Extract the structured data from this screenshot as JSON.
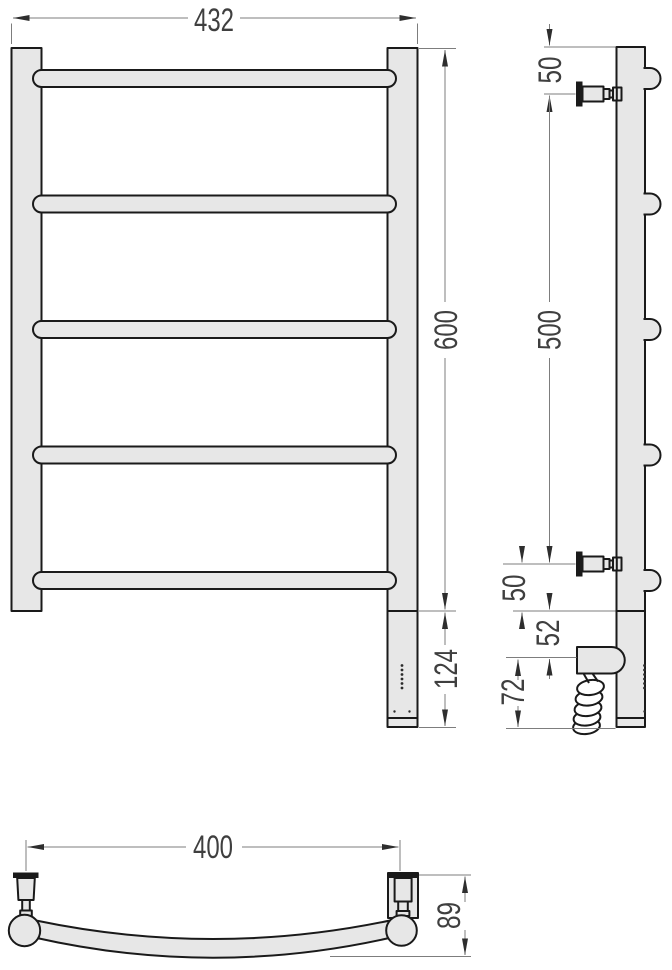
{
  "drawing": {
    "dims": {
      "front_width": "432",
      "front_height": "600",
      "front_bottom": "124",
      "side_top": "50",
      "side_span": "500",
      "side_bottom": "50",
      "side_elem_offset": "52",
      "side_elem": "72",
      "top_width": "400",
      "top_depth": "89"
    },
    "colors": {
      "part_fill": "#e7e7e7",
      "part_outline": "#1a1a1a",
      "dim_line": "#7d7d7d",
      "dim_text": "#3f3f3f",
      "background": "#ffffff"
    }
  }
}
